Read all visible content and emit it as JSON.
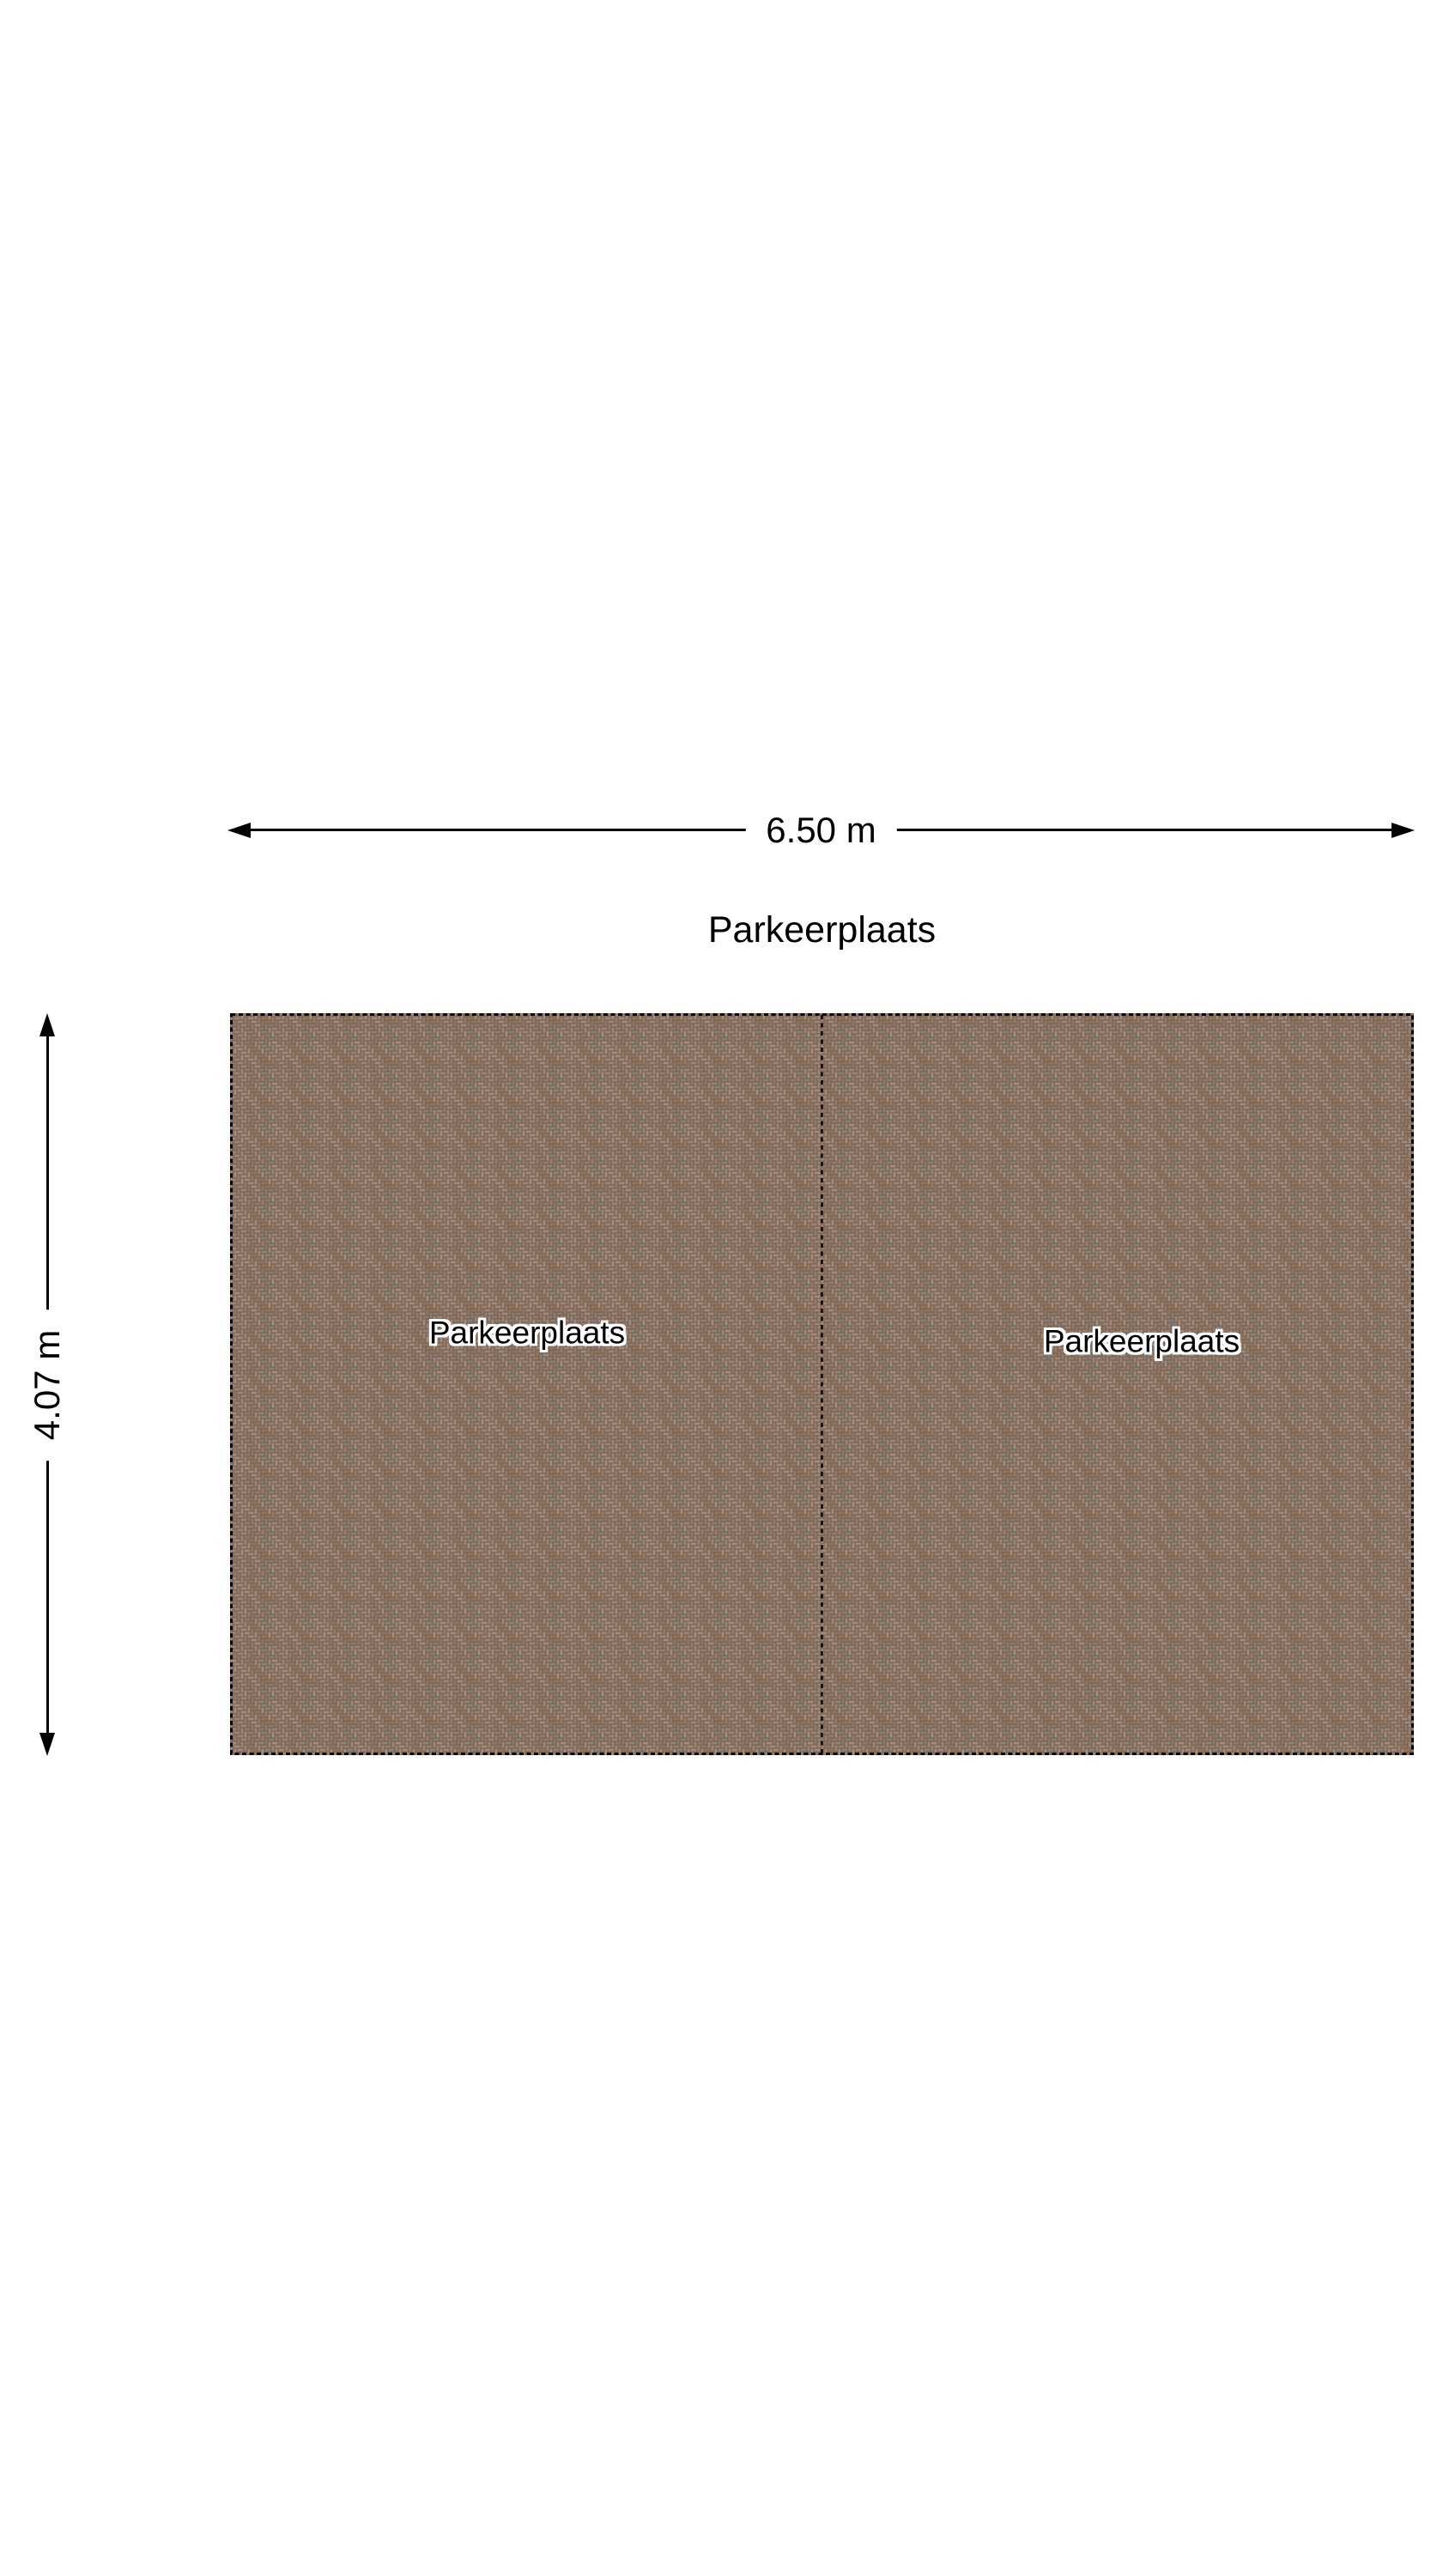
{
  "title": "Parkeerplaats",
  "dimension_width": {
    "label": "6.50 m"
  },
  "dimension_height": {
    "label": "4.07 m"
  },
  "parking_spaces": [
    {
      "label": "Parkeerplaats"
    },
    {
      "label": "Parkeerplaats"
    }
  ],
  "colors": {
    "background": "#ffffff",
    "line": "#000000",
    "label_text": "#000000",
    "label_halo": "#ffffff",
    "brick_joint": "#6e5f53",
    "brick_palette": [
      "#a2836f",
      "#977a69",
      "#8e8177",
      "#a58a79",
      "#8a7c72",
      "#9b8373",
      "#94765f"
    ]
  }
}
